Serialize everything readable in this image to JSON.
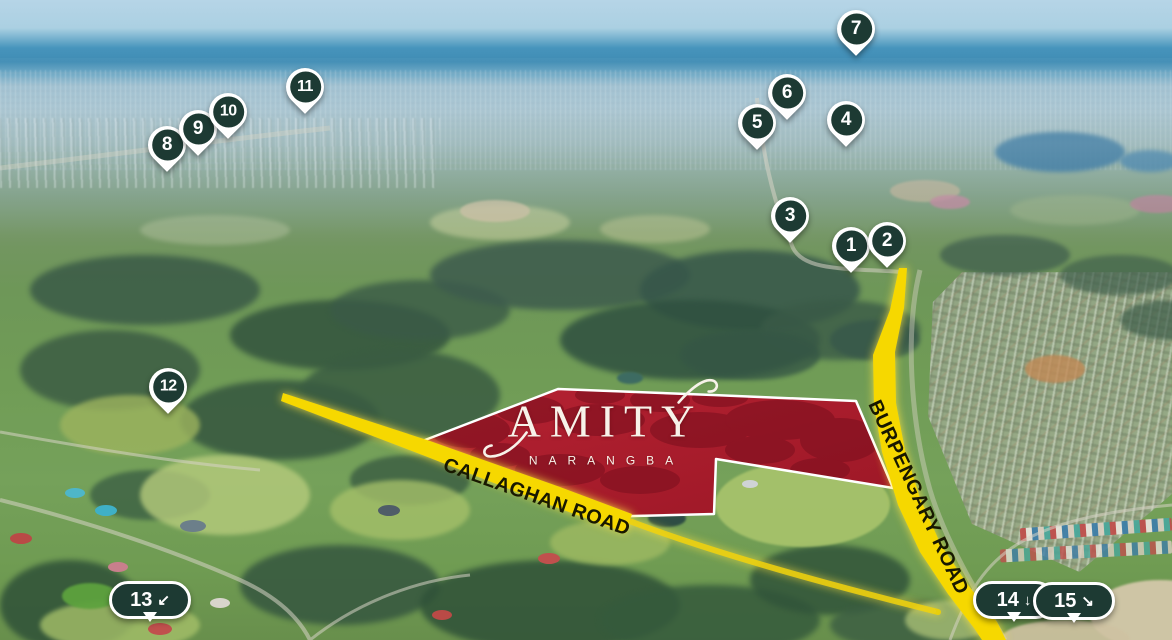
{
  "site": {
    "name": "AMITY",
    "suburb": "NARANGBA"
  },
  "roads": {
    "callaghan": {
      "label": "CALLAGHAN ROAD"
    },
    "burpengary": {
      "label": "BURPENGARY ROAD"
    }
  },
  "site_overlay": {
    "fill_color": "#ad1d2b",
    "border_color": "#ffffff"
  },
  "marker_style": {
    "fill": "#1d3a33",
    "border": "#ffffff",
    "text_color": "#ffffff"
  },
  "road_style": {
    "highlight_color": "#f6d800",
    "label_color": "#181800"
  },
  "markers": [
    {
      "num": "1",
      "shape": "pin",
      "x": 851,
      "y": 246
    },
    {
      "num": "2",
      "shape": "pin",
      "x": 887,
      "y": 241
    },
    {
      "num": "3",
      "shape": "pin",
      "x": 790,
      "y": 216
    },
    {
      "num": "4",
      "shape": "pin",
      "x": 846,
      "y": 120
    },
    {
      "num": "5",
      "shape": "pin",
      "x": 757,
      "y": 123
    },
    {
      "num": "6",
      "shape": "pin",
      "x": 787,
      "y": 93
    },
    {
      "num": "7",
      "shape": "pin",
      "x": 856,
      "y": 29
    },
    {
      "num": "8",
      "shape": "pin",
      "x": 167,
      "y": 145
    },
    {
      "num": "9",
      "shape": "pin",
      "x": 198,
      "y": 129
    },
    {
      "num": "10",
      "shape": "pin",
      "x": 228,
      "y": 112
    },
    {
      "num": "11",
      "shape": "pin",
      "x": 305,
      "y": 87
    },
    {
      "num": "12",
      "shape": "pin",
      "x": 168,
      "y": 387
    },
    {
      "num": "13",
      "shape": "bubble",
      "arrow": "↙",
      "x": 150,
      "y": 600
    },
    {
      "num": "14",
      "shape": "bubble",
      "arrow": "↓",
      "x": 1014,
      "y": 600
    },
    {
      "num": "15",
      "shape": "bubble",
      "arrow": "↘",
      "x": 1074,
      "y": 601
    }
  ]
}
